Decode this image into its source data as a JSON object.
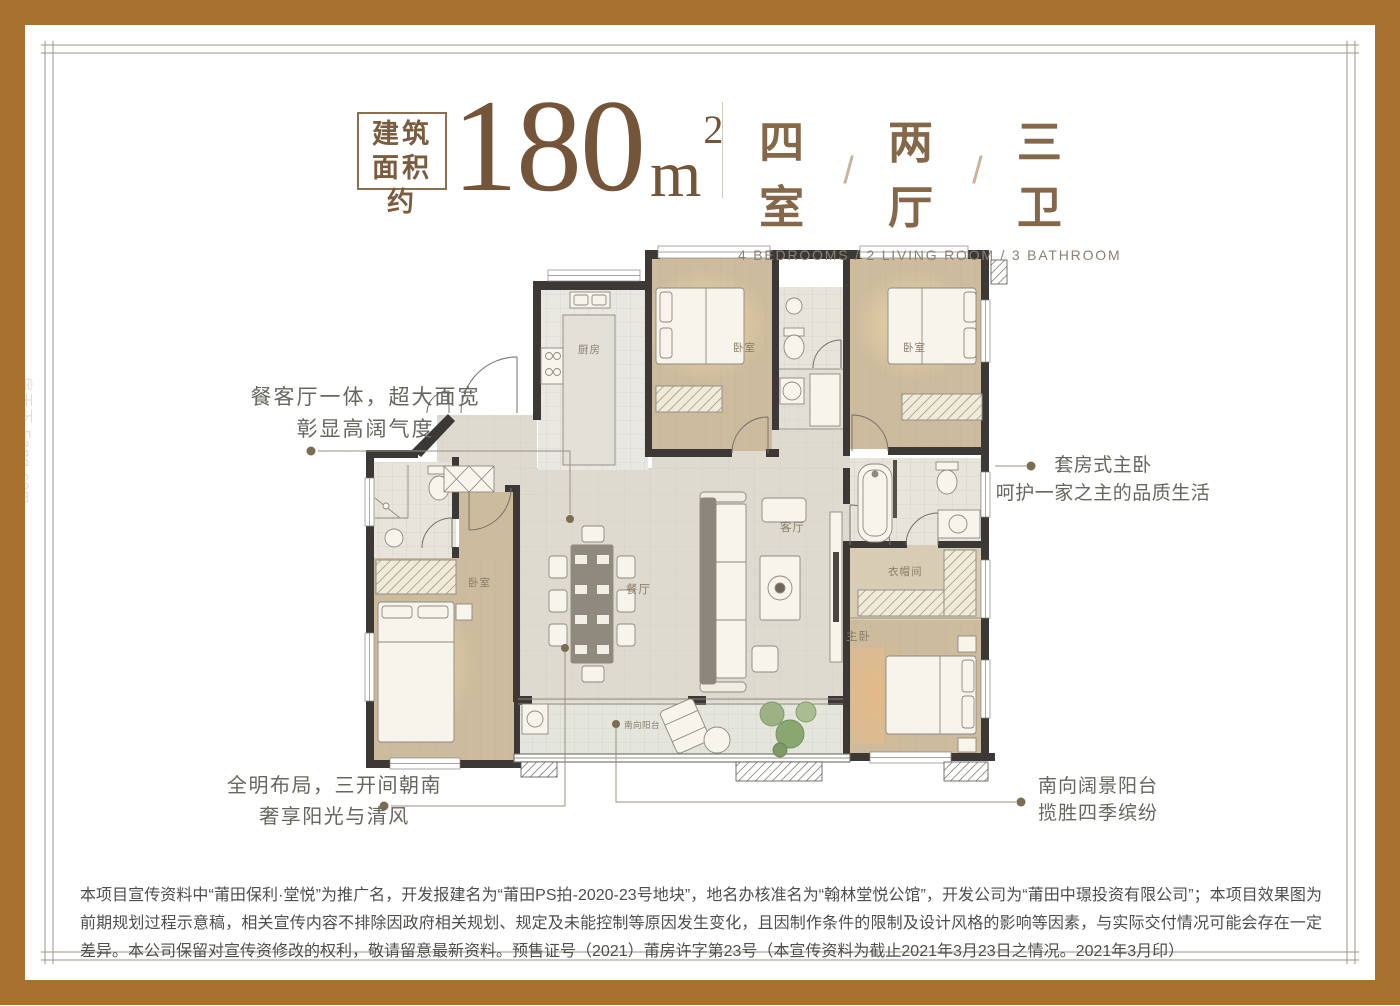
{
  "header": {
    "area_tag": {
      "line1": "建筑",
      "line2": "面积约"
    },
    "area": {
      "value": "180",
      "unit": "m",
      "sup": "2"
    },
    "rooms_cn": {
      "r1": "四室",
      "sep1": "/",
      "r2": "两厅",
      "sep2": "/",
      "r3": "三卫"
    },
    "rooms_en": "4 BEDROOMS  /  2 LIVING ROOM  /  3 BATHROOM"
  },
  "annotations": {
    "left": {
      "line1": "餐客厅一体，超大面宽",
      "line2": "彰显高阔气度"
    },
    "right": {
      "line1": "套房式主卧",
      "line2": "呵护一家之主的品质生活"
    },
    "bottom_left": {
      "line1": "全明布局，三开间朝南",
      "line2": "奢享阳光与清风"
    },
    "bottom_right": {
      "line1": "南向阔景阳台",
      "line2": "揽胜四季缤纷"
    }
  },
  "floorplan": {
    "labels": {
      "kitchen": "厨房",
      "bedroom_top_mid": "卧室",
      "bedroom_top_right": "卧室",
      "bedroom_left": "卧室",
      "dining": "餐厅",
      "living": "客厅",
      "cloakroom": "衣帽间",
      "master": "主卧",
      "balcony": "南向阳台"
    }
  },
  "disclaimer": "本项目宣传资料中“莆田保利·堂悦”为推广名，开发报建名为“莆田PS拍-2020-23号地块”，地名办核准名为“翰林堂悦公馆”，开发公司为“莆田中璟投资有限公司”；本项目效果图为前期规划过程示意稿，相关宣传内容不排除因政府相关规划、规定及未能控制等原因发生变化，且因制作条件的限制及设计风格的影响等因素，与实际交付情况可能会存在一定差异。本公司保留对宣传资修改的权利，敬请留意最新资料。预售证号（2021）莆房许字第23号（本宣传资料为截止2021年3月23日之情况。2021年3月印）",
  "watermark": "房天下 Fang.com",
  "colors": {
    "frame_brown": "#a8722e",
    "accent_brown": "#85674a",
    "wall_dark": "#3b3835"
  }
}
